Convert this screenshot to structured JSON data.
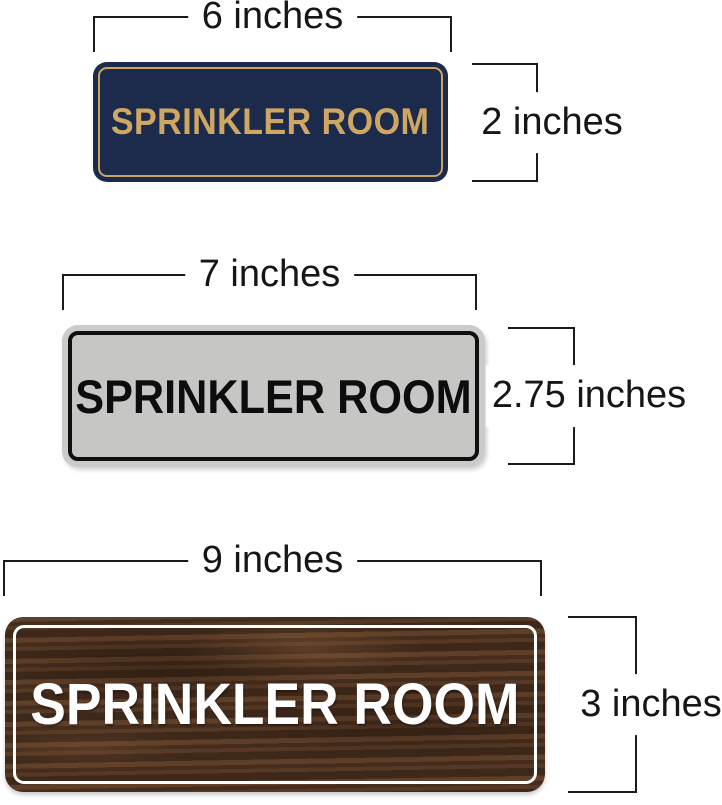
{
  "page": {
    "background_color": "#ffffff",
    "annotation_line_color": "#1b1b1b",
    "annotation_text_color": "#161616"
  },
  "signs": [
    {
      "id": "navy-gold-sign",
      "label": "SPRINKLER ROOM",
      "width_label": "6 inches",
      "height_label": "2 inches",
      "bg_color": "#1c2b4b",
      "text_color": "#cfa763",
      "border_color": "#c9a465"
    },
    {
      "id": "silver-black-sign",
      "label": "SPRINKLER ROOM",
      "width_label": "7 inches",
      "height_label": "2.75 inches",
      "bg_color": "#c6c7c5",
      "text_color": "#0d0d0d",
      "border_color": "#0f0f0f"
    },
    {
      "id": "walnut-wood-sign",
      "label": "SPRINKLER ROOM",
      "width_label": "9 inches",
      "height_label": "3 inches",
      "bg_color": "#4e3423",
      "text_color": "#ffffff",
      "border_color": "#ffffff"
    }
  ]
}
